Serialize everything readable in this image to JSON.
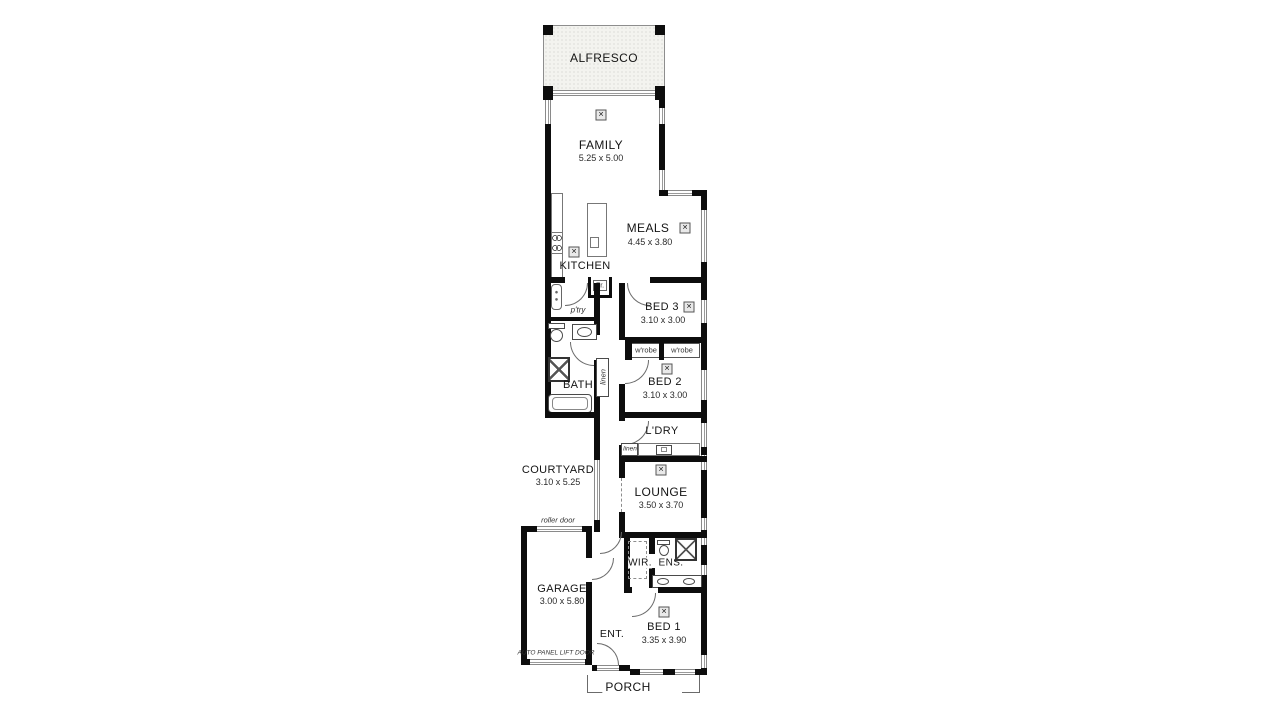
{
  "rooms": {
    "alfresco": {
      "name": "ALFRESCO"
    },
    "family": {
      "name": "FAMILY",
      "dims": "5.25 x 5.00"
    },
    "meals": {
      "name": "MEALS",
      "dims": "4.45 x 3.80"
    },
    "kitchen": {
      "name": "KITCHEN"
    },
    "pantry": {
      "name": "p'try"
    },
    "fridge": {
      "name": "Fr."
    },
    "bed3": {
      "name": "BED 3",
      "dims": "3.10 x 3.00"
    },
    "wrobe_left": {
      "name": "w'robe"
    },
    "wrobe_right": {
      "name": "w'robe"
    },
    "bed2": {
      "name": "BED 2",
      "dims": "3.10 x 3.00"
    },
    "bath": {
      "name": "BATH"
    },
    "linen_bath": {
      "name": "linen"
    },
    "ldry": {
      "name": "L'DRY"
    },
    "linen_ldry": {
      "name": "linen"
    },
    "courtyard": {
      "name": "COURTYARD",
      "dims": "3.10 x 5.25"
    },
    "lounge": {
      "name": "LOUNGE",
      "dims": "3.50 x 3.70"
    },
    "roller_door": {
      "name": "roller door"
    },
    "garage": {
      "name": "GARAGE",
      "dims": "3.00 x 5.80"
    },
    "auto_panel": {
      "name": "AUTO PANEL LIFT DOOR"
    },
    "wir": {
      "name": "WIR."
    },
    "ens": {
      "name": "ENS."
    },
    "ent": {
      "name": "ENT."
    },
    "bed1": {
      "name": "BED 1",
      "dims": "3.35 x 3.90"
    },
    "porch": {
      "name": "PORCH"
    }
  },
  "icons": {
    "ceiling_fan": "✕"
  },
  "colors": {
    "wall": "#0d0d0d",
    "line": "#6b6b6b",
    "paper": "#ffffff",
    "alfresco_fill": "#f3f3ef"
  }
}
